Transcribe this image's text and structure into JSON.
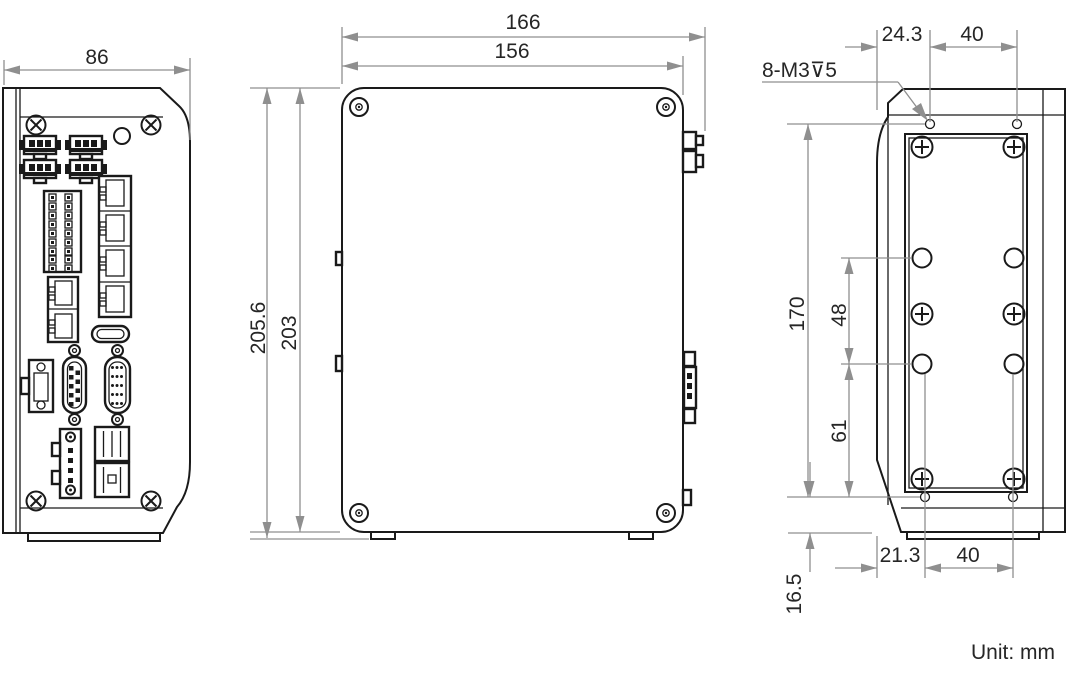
{
  "drawing": {
    "unit_label": "Unit: mm",
    "front_view": {
      "width": "86"
    },
    "side_view": {
      "overall_width": "166",
      "panel_width": "156",
      "overall_height": "205.6",
      "panel_height": "203"
    },
    "back_view": {
      "thread_callout": "8-M3⊽5",
      "top_hole_offset": "24.3",
      "top_hole_spacing": "40",
      "hole_column_height": "170",
      "upper_hole_gap": "48",
      "lower_hole_gap": "61",
      "bottom_hole_offset": "21.3",
      "bottom_hole_spacing": "40",
      "base_offset": "16.5"
    }
  }
}
